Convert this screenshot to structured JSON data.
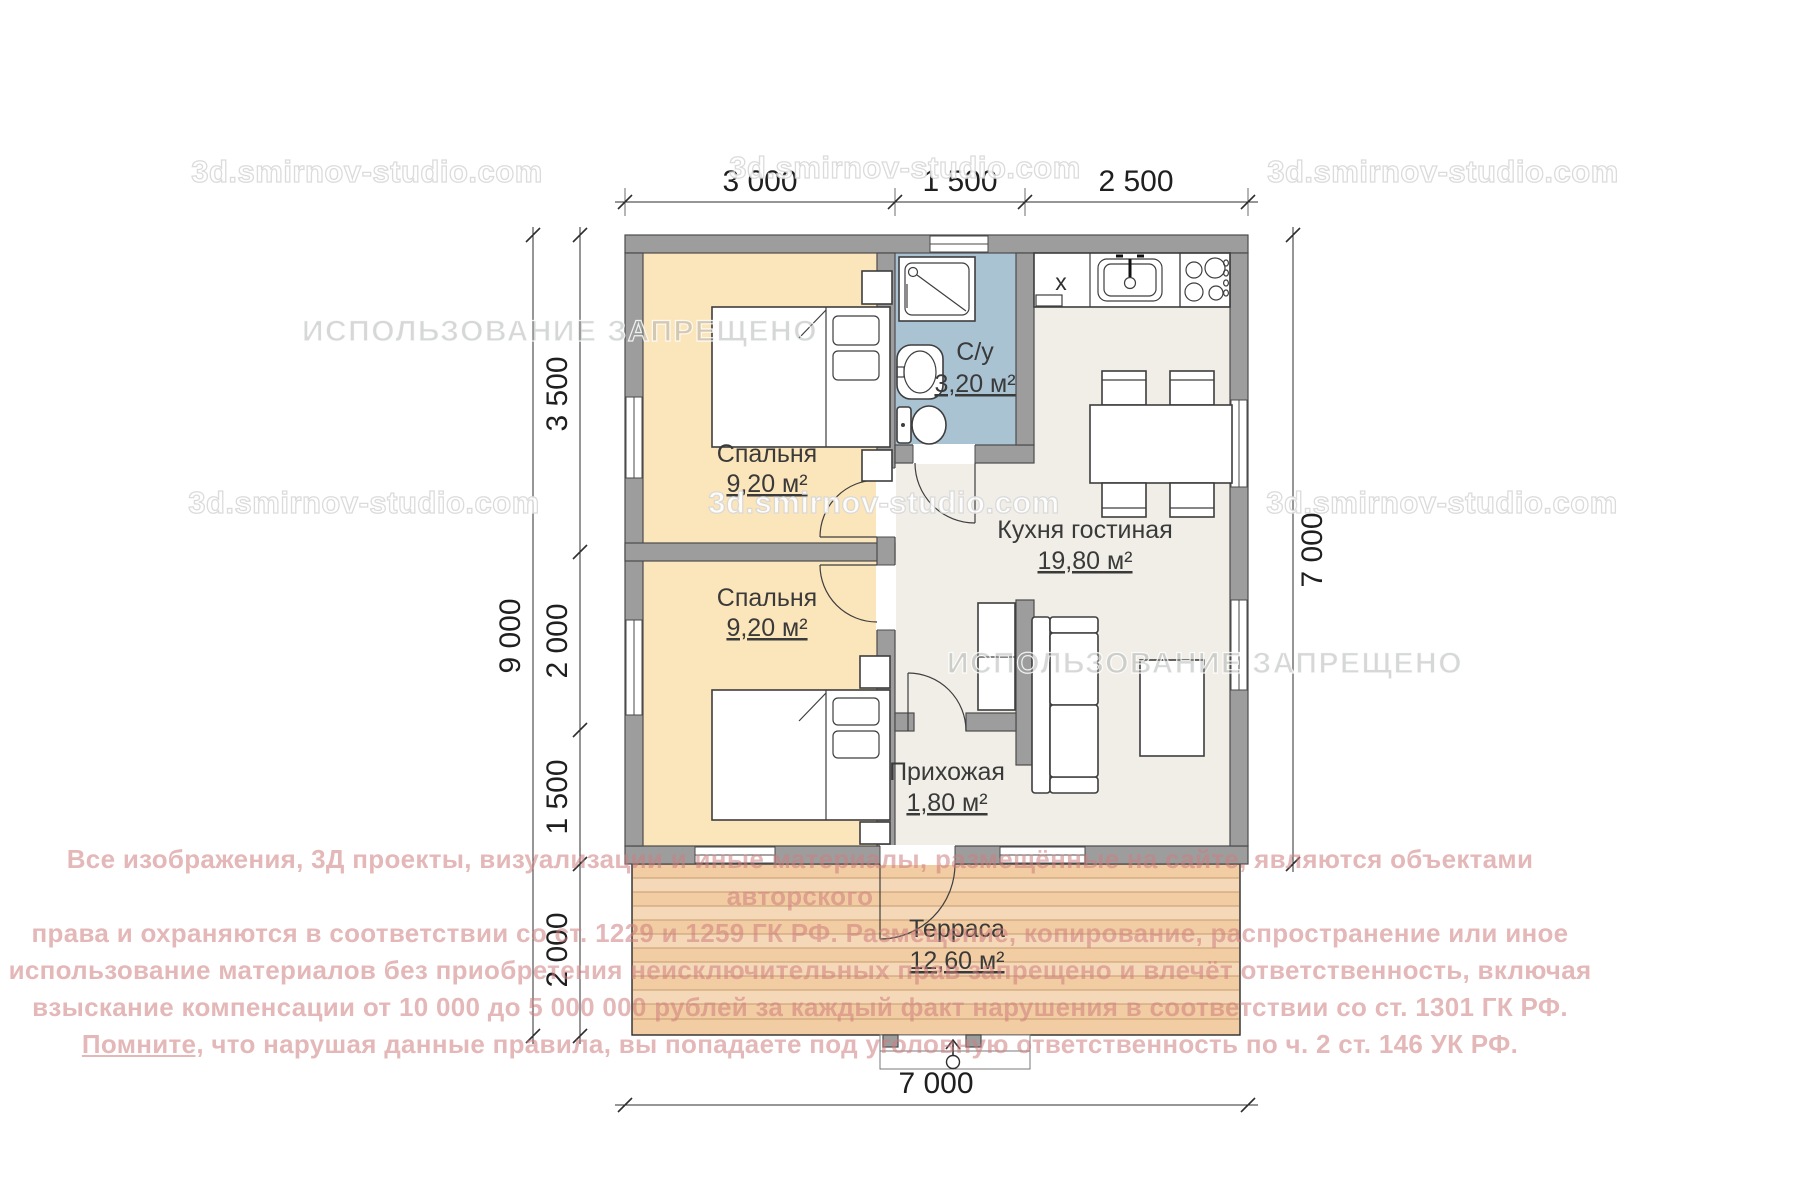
{
  "watermarks": {
    "site": "3d.smirnov-studio.com",
    "forbidden": "ИСПОЛЬЗОВАНИЕ ЗАПРЕЩЕНО"
  },
  "dimensions": {
    "top": [
      "3 000",
      "1 500",
      "2 500"
    ],
    "left_total": "9 000",
    "left_segments": [
      "3 500",
      "2 000",
      "1 500",
      "2 000"
    ],
    "right": "7 000",
    "bottom": "7 000"
  },
  "rooms": {
    "bedroom1": {
      "name": "Спальня",
      "area": "9,20 м²"
    },
    "bedroom2": {
      "name": "Спальня",
      "area": "9,20 м²"
    },
    "bathroom": {
      "name": "С/у",
      "area": "3,20 м²"
    },
    "kitchen_living": {
      "name": "Кухня гостиная",
      "area": "19,80 м²"
    },
    "hallway": {
      "name": "Прихожая",
      "area": "1,80 м²"
    },
    "terrace": {
      "name": "Терраса",
      "area": "12,60 м²"
    }
  },
  "appliances": {
    "fridge_label": "x"
  },
  "copyright": {
    "lines": [
      "Все изображения, 3Д проекты, визуализации и иные материалы, размещённые на сайте, являются объектами авторского",
      "права и охраняются в соответствии со ст. 1229 и 1259 ГК РФ. Размещение, копирование, распространение или иное",
      "использование материалов без приобретения неисключительных прав запрещено и влечёт ответственность, включая",
      "взыскание компенсации от 10 000 до 5 000 000 рублей за каждый факт нарушения в соответствии со ст. 1301 ГК РФ."
    ],
    "line5_lead": "Помните,",
    "line5_rest": " что нарушая данные правила, вы попадаете под уголовную ответственность по ч. 2 ст. 146 УК РФ."
  },
  "colors": {
    "bedroom_fill": "#fbe5bb",
    "bathroom_fill": "#aac3d3",
    "floor_fill": "#f0eee6",
    "terrace_fill": "#f2cda3",
    "wall_fill": "#9d9d9d",
    "watermark_pink": "#cd7d7d"
  }
}
